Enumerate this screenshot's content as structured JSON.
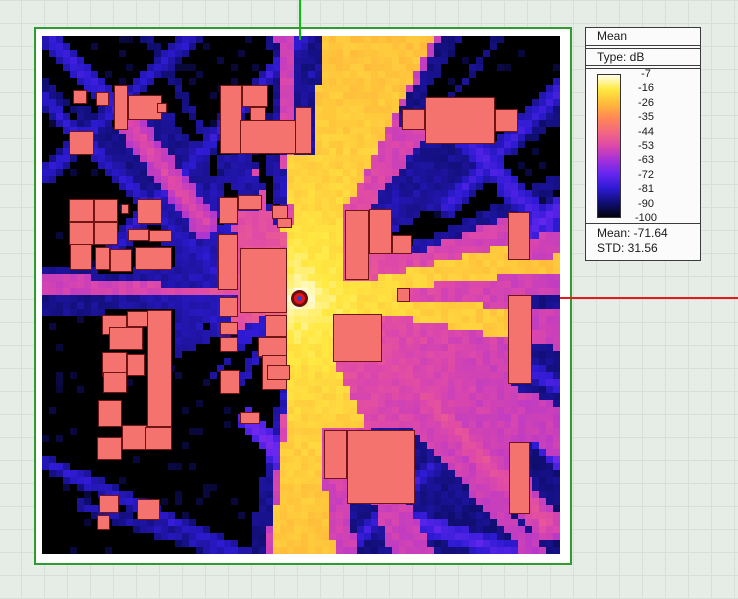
{
  "legend": {
    "title": "Mean",
    "type_label": "Type: dB",
    "mean_text": "Mean: -71.64",
    "std_text": "STD: 31.56"
  },
  "colors": {
    "frame_green": "#2F9C2F",
    "crosshair_green": "#0BBE0B",
    "crosshair_red": "#E31B1B",
    "building_fill": "#F4736E",
    "building_border": "#701414",
    "grid_bg": "#E6ECE6",
    "grid_line": "#D8DED8",
    "tx_ring": "#6F0D0D",
    "tx_fill": "#E31515",
    "tx_center": "#2244DD"
  },
  "chart_data": {
    "type": "heatmap",
    "title": "Mean",
    "units": "dB",
    "colorbar_ticks": [
      "-7",
      "-16",
      "-26",
      "-35",
      "-44",
      "-53",
      "-63",
      "-72",
      "-81",
      "-90",
      "-100"
    ],
    "mean_db": -71.64,
    "std_db": 31.56,
    "map_size_px": 518,
    "grid_cells": 74,
    "transmitter": {
      "x": 257,
      "y": 262
    },
    "propagation_model": {
      "p0_db": -7,
      "ref_px": 6,
      "loss_per_decade_db": 10.5,
      "wall_loss_db": 32
    },
    "color_scale": {
      "stops": [
        {
          "db": -7,
          "rgb": [
            255,
            255,
            235
          ]
        },
        {
          "db": -16,
          "rgb": [
            255,
            233,
            66
          ]
        },
        {
          "db": -26,
          "rgb": [
            255,
            187,
            58
          ]
        },
        {
          "db": -35,
          "rgb": [
            255,
            136,
            84
          ]
        },
        {
          "db": -44,
          "rgb": [
            244,
            104,
            128
          ]
        },
        {
          "db": -53,
          "rgb": [
            221,
            72,
            170
          ]
        },
        {
          "db": -63,
          "rgb": [
            163,
            48,
            218
          ]
        },
        {
          "db": -72,
          "rgb": [
            100,
            38,
            240
          ]
        },
        {
          "db": -81,
          "rgb": [
            45,
            26,
            210
          ]
        },
        {
          "db": -90,
          "rgb": [
            16,
            14,
            115
          ]
        },
        {
          "db": -100,
          "rgb": [
            3,
            3,
            14
          ]
        }
      ]
    },
    "buildings_xywh": [
      [
        31,
        54,
        14,
        14
      ],
      [
        54,
        56,
        13,
        14
      ],
      [
        72,
        49,
        14,
        45
      ],
      [
        86,
        59,
        34,
        25
      ],
      [
        115,
        67,
        10,
        10
      ],
      [
        27,
        95,
        25,
        24
      ],
      [
        178,
        49,
        22,
        69
      ],
      [
        200,
        49,
        26,
        22
      ],
      [
        208,
        71,
        16,
        16
      ],
      [
        198,
        84,
        72,
        34
      ],
      [
        253,
        71,
        17,
        47
      ],
      [
        27,
        163,
        25,
        23
      ],
      [
        52,
        163,
        24,
        23
      ],
      [
        27,
        186,
        25,
        23
      ],
      [
        52,
        186,
        24,
        23
      ],
      [
        79,
        168,
        8,
        10
      ],
      [
        95,
        163,
        25,
        25
      ],
      [
        86,
        193,
        21,
        12
      ],
      [
        107,
        194,
        23,
        12
      ],
      [
        28,
        208,
        22,
        26
      ],
      [
        53,
        211,
        15,
        23
      ],
      [
        68,
        213,
        22,
        23
      ],
      [
        93,
        211,
        37,
        23
      ],
      [
        177,
        161,
        19,
        27
      ],
      [
        196,
        159,
        24,
        15
      ],
      [
        230,
        169,
        16,
        14
      ],
      [
        235,
        182,
        15,
        10
      ],
      [
        176,
        198,
        20,
        56
      ],
      [
        198,
        212,
        47,
        65
      ],
      [
        223,
        279,
        22,
        22
      ],
      [
        216,
        301,
        29,
        20
      ],
      [
        220,
        319,
        25,
        35
      ],
      [
        177,
        261,
        19,
        20
      ],
      [
        178,
        286,
        18,
        13
      ],
      [
        178,
        301,
        18,
        15
      ],
      [
        178,
        334,
        20,
        24
      ],
      [
        198,
        376,
        20,
        12
      ],
      [
        225,
        329,
        23,
        15
      ],
      [
        60,
        279,
        25,
        20
      ],
      [
        85,
        275,
        21,
        16
      ],
      [
        67,
        291,
        34,
        23
      ],
      [
        60,
        316,
        25,
        25
      ],
      [
        85,
        318,
        18,
        22
      ],
      [
        61,
        336,
        24,
        21
      ],
      [
        56,
        364,
        24,
        27
      ],
      [
        80,
        389,
        25,
        25
      ],
      [
        55,
        401,
        25,
        23
      ],
      [
        105,
        274,
        25,
        117
      ],
      [
        103,
        391,
        27,
        23
      ],
      [
        57,
        459,
        20,
        18
      ],
      [
        55,
        479,
        13,
        15
      ],
      [
        95,
        463,
        23,
        21
      ],
      [
        291,
        278,
        49,
        48
      ],
      [
        355,
        252,
        13,
        14
      ],
      [
        282,
        394,
        23,
        49
      ],
      [
        305,
        394,
        68,
        74
      ],
      [
        466,
        259,
        24,
        89
      ],
      [
        467,
        406,
        21,
        72
      ],
      [
        383,
        61,
        70,
        47
      ],
      [
        360,
        73,
        23,
        21
      ],
      [
        453,
        73,
        23,
        23
      ],
      [
        303,
        174,
        24,
        70
      ],
      [
        327,
        173,
        23,
        45
      ],
      [
        350,
        199,
        20,
        19
      ],
      [
        466,
        176,
        22,
        48
      ]
    ],
    "reflection_streaks": [
      {
        "from": [
          163,
          188
        ],
        "to": [
          88,
          88
        ],
        "width": 13,
        "db": -52
      },
      {
        "from": [
          88,
          88
        ],
        "to": [
          12,
          6
        ],
        "width": 10,
        "db": -77
      },
      {
        "from": [
          352,
          330
        ],
        "to": [
          505,
          488
        ],
        "width": 17,
        "db": -50
      },
      {
        "from": [
          150,
          0
        ],
        "to": [
          0,
          142
        ],
        "width": 9,
        "db": -80
      },
      {
        "from": [
          0,
          62
        ],
        "to": [
          196,
          256
        ],
        "width": 9,
        "db": -80
      },
      {
        "from": [
          262,
          0
        ],
        "to": [
          70,
          216
        ],
        "width": 9,
        "db": -79
      },
      {
        "from": [
          305,
          0
        ],
        "to": [
          176,
          146
        ],
        "width": 8,
        "db": -84
      },
      {
        "from": [
          208,
          384
        ],
        "to": [
          288,
          484
        ],
        "width": 10,
        "db": -69
      },
      {
        "from": [
          0,
          425
        ],
        "to": [
          206,
          521
        ],
        "width": 8,
        "db": -80
      },
      {
        "from": [
          40,
          470
        ],
        "to": [
          240,
          536
        ],
        "width": 7,
        "db": -83
      },
      {
        "from": [
          418,
          95
        ],
        "to": [
          517,
          205
        ],
        "width": 12,
        "db": -76
      },
      {
        "from": [
          517,
          55
        ],
        "to": [
          405,
          170
        ],
        "width": 10,
        "db": -78
      },
      {
        "from": [
          430,
          237
        ],
        "to": [
          517,
          172
        ],
        "width": 10,
        "db": -73
      },
      {
        "from": [
          345,
          476
        ],
        "to": [
          470,
          517
        ],
        "width": 10,
        "db": -74
      },
      {
        "from": [
          470,
          370
        ],
        "to": [
          517,
          426
        ],
        "width": 8,
        "db": -72
      },
      {
        "from": [
          390,
          430
        ],
        "to": [
          300,
          519
        ],
        "width": 8,
        "db": -78
      },
      {
        "from": [
          450,
          310
        ],
        "to": [
          517,
          352
        ],
        "width": 8,
        "db": -76
      }
    ]
  }
}
